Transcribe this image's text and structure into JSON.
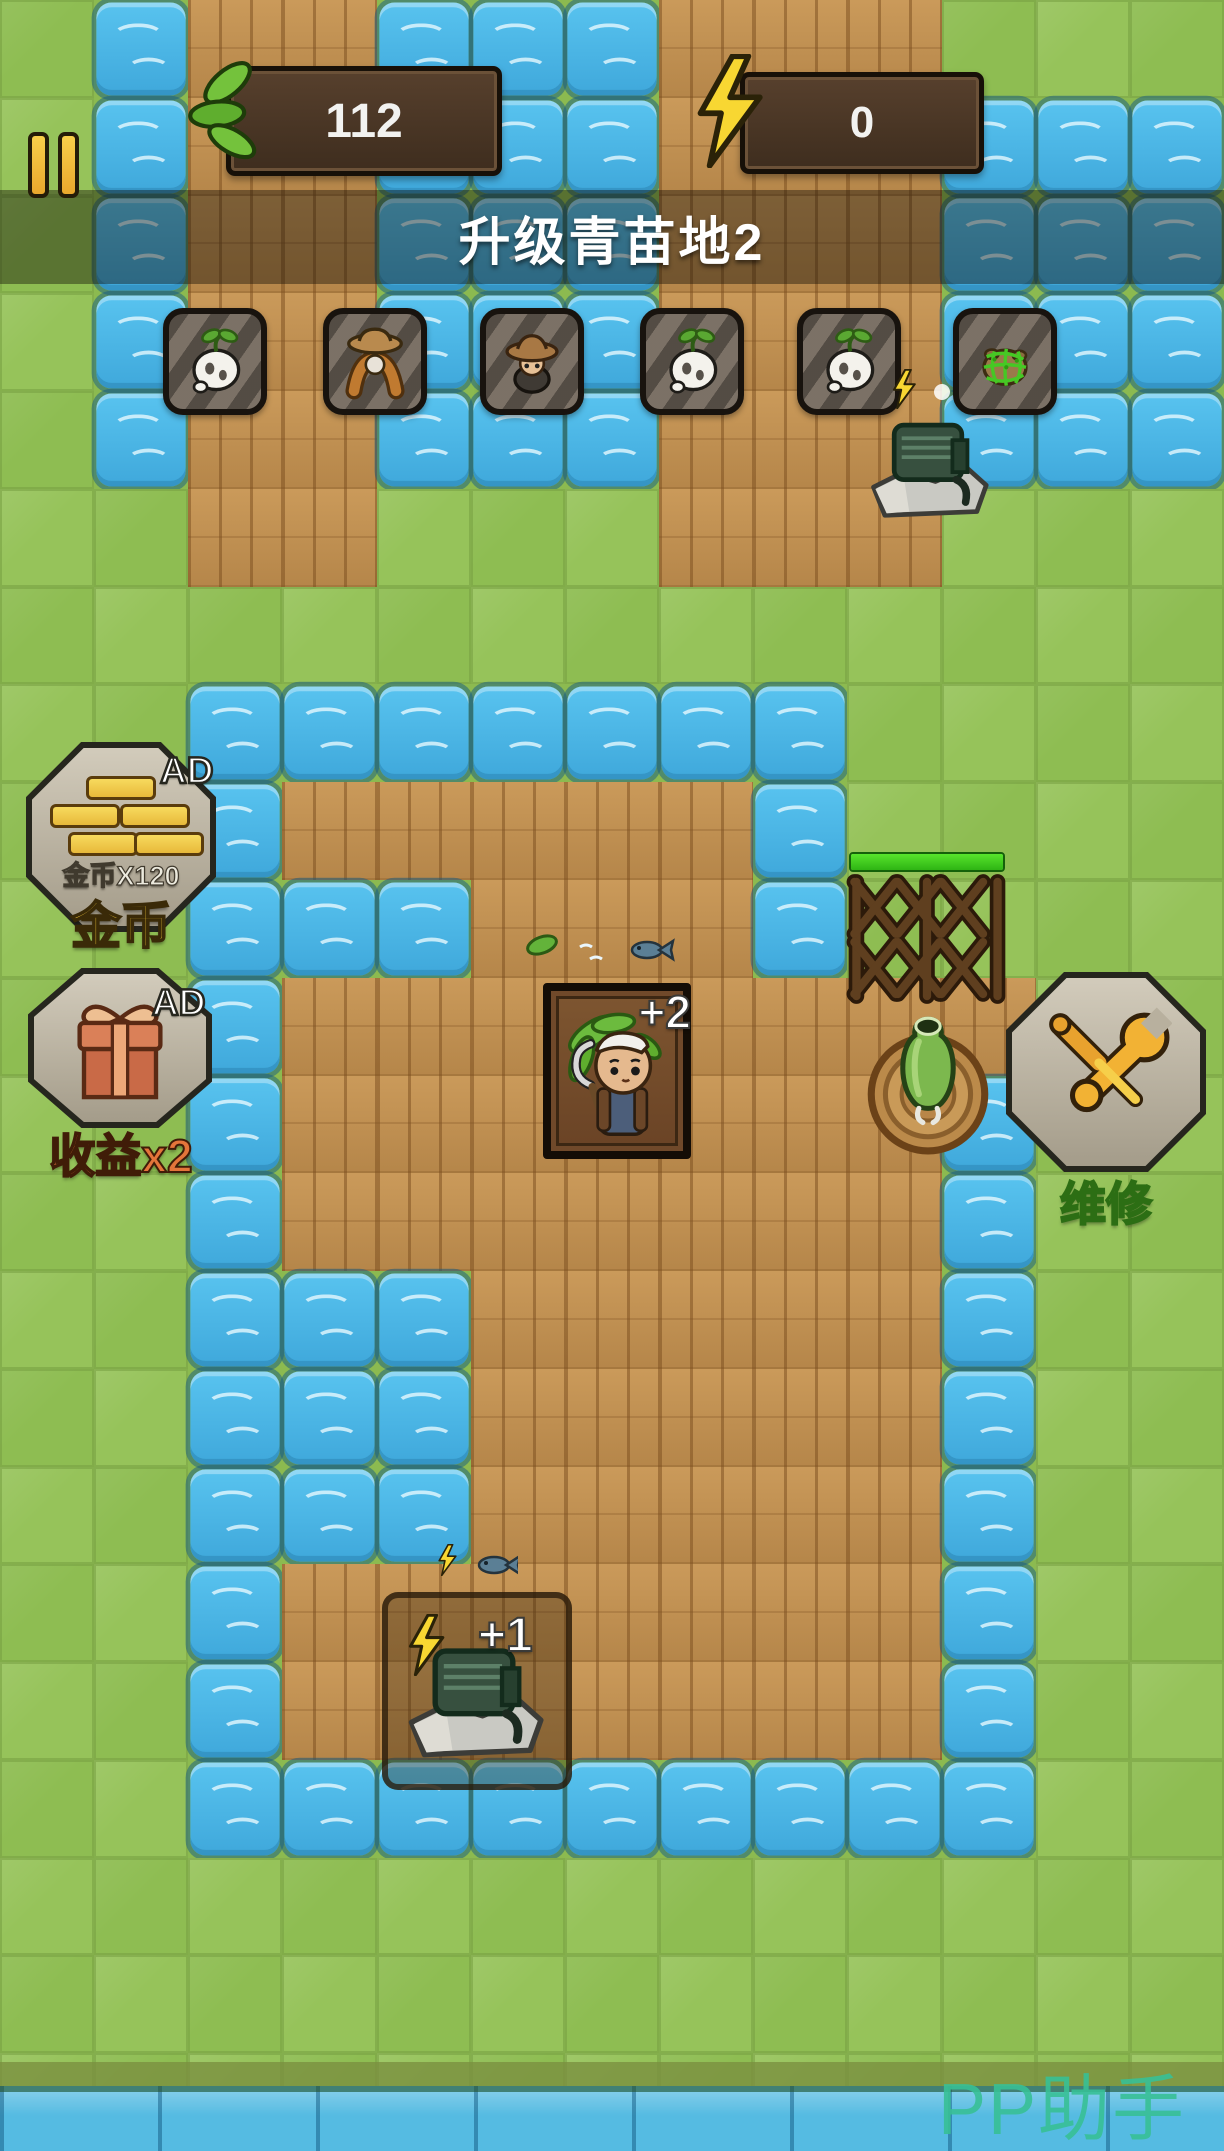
{
  "hud": {
    "pause_icon": "pause-icon",
    "leaf_counter": {
      "icon": "leaf-icon",
      "value": "112"
    },
    "energy_counter": {
      "icon": "lightning-icon",
      "value": "0"
    },
    "banner": {
      "title": "升级青苗地2"
    }
  },
  "toolbar_slots": [
    {
      "id": "slot-1",
      "icon": "turnip",
      "icon_ref": "#icon-turnip"
    },
    {
      "id": "slot-2",
      "icon": "scarecrow",
      "icon_ref": "#icon-scarecrow"
    },
    {
      "id": "slot-3",
      "icon": "farmer",
      "icon_ref": "#icon-farmer"
    },
    {
      "id": "slot-4",
      "icon": "turnip",
      "icon_ref": "#icon-turnip"
    },
    {
      "id": "slot-5",
      "icon": "turnip",
      "icon_ref": "#icon-turnip"
    },
    {
      "id": "slot-6",
      "icon": "netted-creature",
      "icon_ref": "#icon-net"
    }
  ],
  "ad_buttons": [
    {
      "id": "coins",
      "badge": "AD",
      "icon": "gold-bars",
      "caption": "金币X120",
      "label": "金币"
    },
    {
      "id": "double-income",
      "badge": "AD",
      "icon": "gift-box",
      "label": "收益x2"
    }
  ],
  "repair_button": {
    "icon": "tools",
    "label": "维修"
  },
  "map_objects": {
    "portrait_bonus": "+2",
    "generator_bonus": "+1",
    "fence_health_percent": 100
  },
  "watermark": "PP助手",
  "map": {
    "legend": {
      "G": "grass",
      "W": "water",
      "P": "plank"
    },
    "cols": 13,
    "rows": [
      "GWPPWWWPPPGGG",
      "GWPPWWWPPPWWW",
      "GWPPWWWPPPWWW",
      "GWPPWWWPPPWWW",
      "GWPPWWWPPPWWW",
      "GGPPGGGPPPGGG",
      "GGGGGGGGGGGGG",
      "GGWWWWWWWGGGG",
      "GGWPPPPPWGGGG",
      "GGWWWPPPWGGGG",
      "GGWPPPPPPPPGG",
      "GGWPPPPPPPWGG",
      "GGWPPPPPPPWGG",
      "GGWWWPPPPPWGG",
      "GGWWWPPPPPWGG",
      "GGWWWPPPPPWGG",
      "GGWPPPPPPPWGG",
      "GGWPPPPPPPWGG",
      "GGWWWWWWWWWGG",
      "GGGGGGGGGGGGG",
      "GGGGGGGGGGGGG",
      "GGGGGGGGGGGGG"
    ]
  },
  "colors": {
    "grass": "#8cba50",
    "grass_alt": "#96c35a",
    "water": "#4ab6e8",
    "plank": "#c3904f",
    "hud_wood": "#4a3526",
    "accent_yellow": "#f2c83a",
    "banner_text": "#ffffff",
    "repair_label": "#86df52",
    "income_label": "#e4753a",
    "watermark": "#38c096",
    "health_green": "#3ecc1e"
  }
}
